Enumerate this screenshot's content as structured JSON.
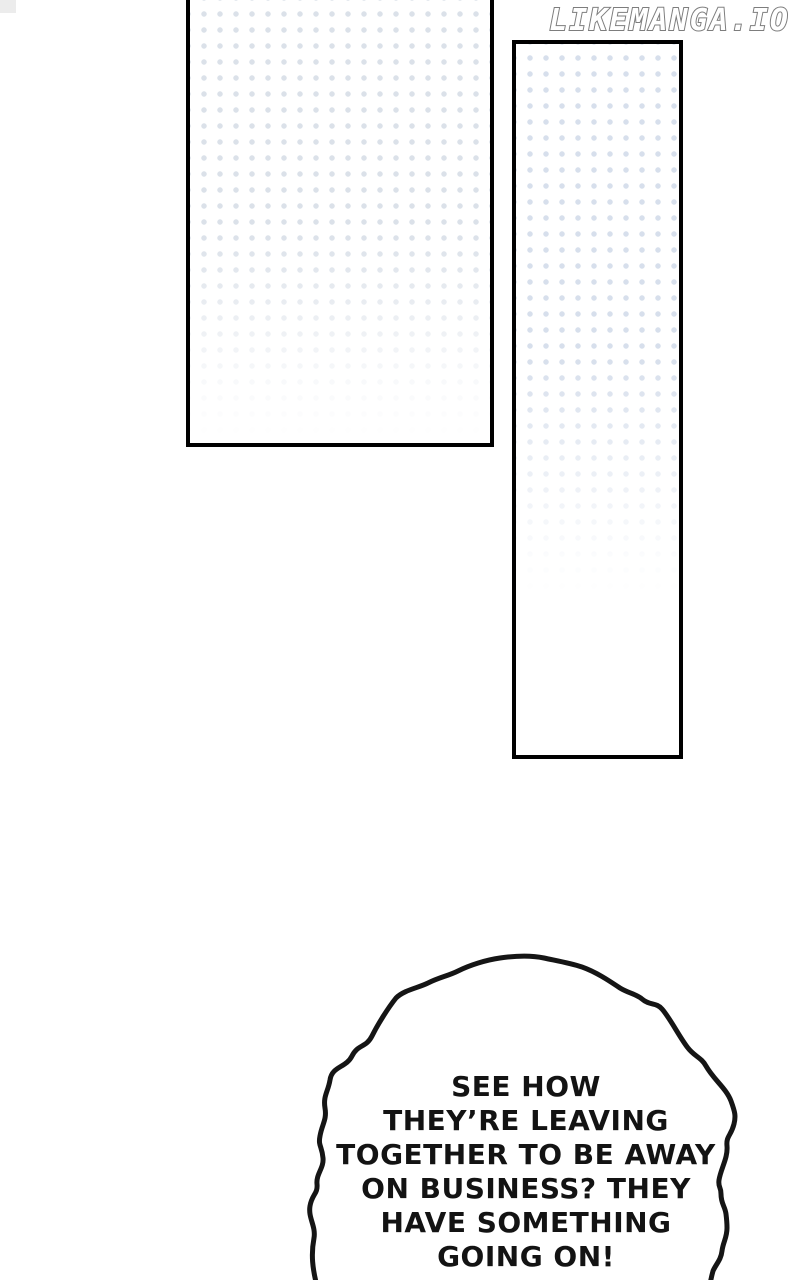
{
  "site_watermark": {
    "text": "LIKEMANGA.IO",
    "fill_color": "#ffffff",
    "outline_color": "#7d7d7d"
  },
  "page": {
    "background_color": "#ffffff",
    "panel_border_color": "#000000"
  },
  "panels": [
    {
      "id": "panel-top-left",
      "pattern": "halftone-dots",
      "dot_color": "#dbe1e9",
      "fill_color": "#ffffff"
    },
    {
      "id": "panel-right",
      "pattern": "halftone-dots",
      "dot_color": "#d7dfec",
      "fill_color": "#ffffff"
    }
  ],
  "speech_bubble": {
    "shape": "cloud",
    "fill_color": "#ffffff",
    "outline_color": "#151515",
    "text_color": "#131313",
    "text": "SEE HOW\nTHEY’RE LEAVING\nTOGETHER TO BE AWAY\nON BUSINESS? THEY\nHAVE SOMETHING\nGOING ON!"
  }
}
